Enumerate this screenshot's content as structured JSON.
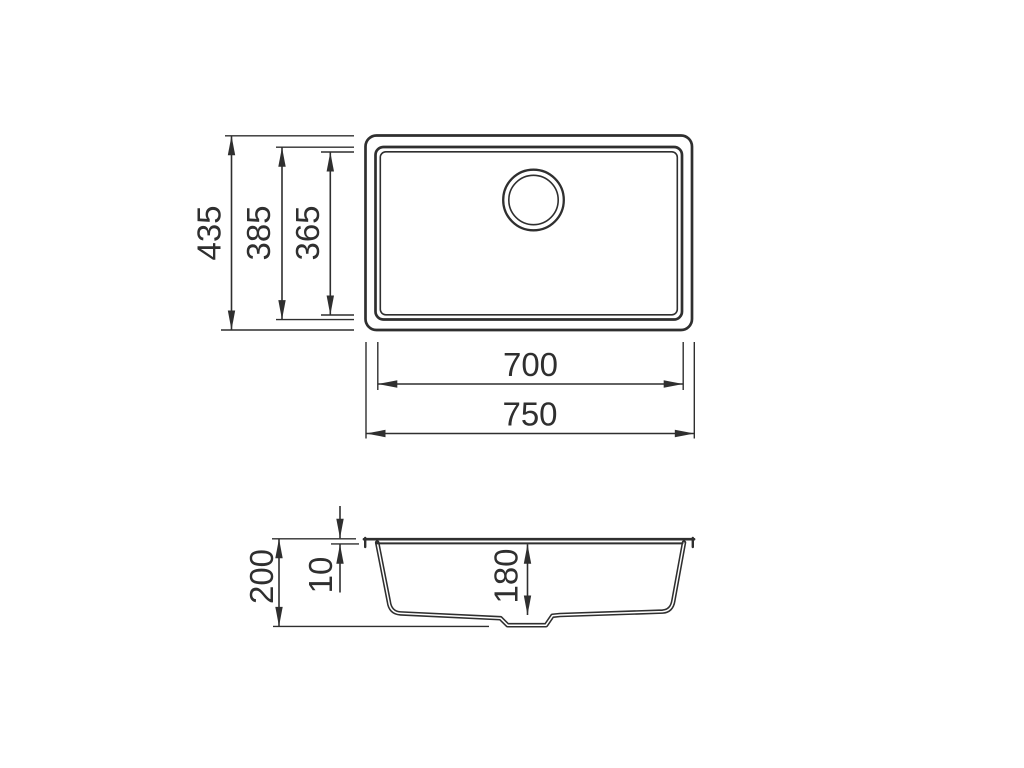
{
  "drawing": {
    "colors": {
      "background": "#ffffff",
      "line": "#2f2f2f"
    },
    "top_view": {
      "dims": {
        "overall_height": "435",
        "bowl_height": "385",
        "bowl_inner_height": "365",
        "bowl_width": "700",
        "overall_width": "750"
      }
    },
    "section_view": {
      "dims": {
        "overall_depth": "200",
        "rim_height": "10",
        "bowl_depth": "180"
      }
    }
  }
}
